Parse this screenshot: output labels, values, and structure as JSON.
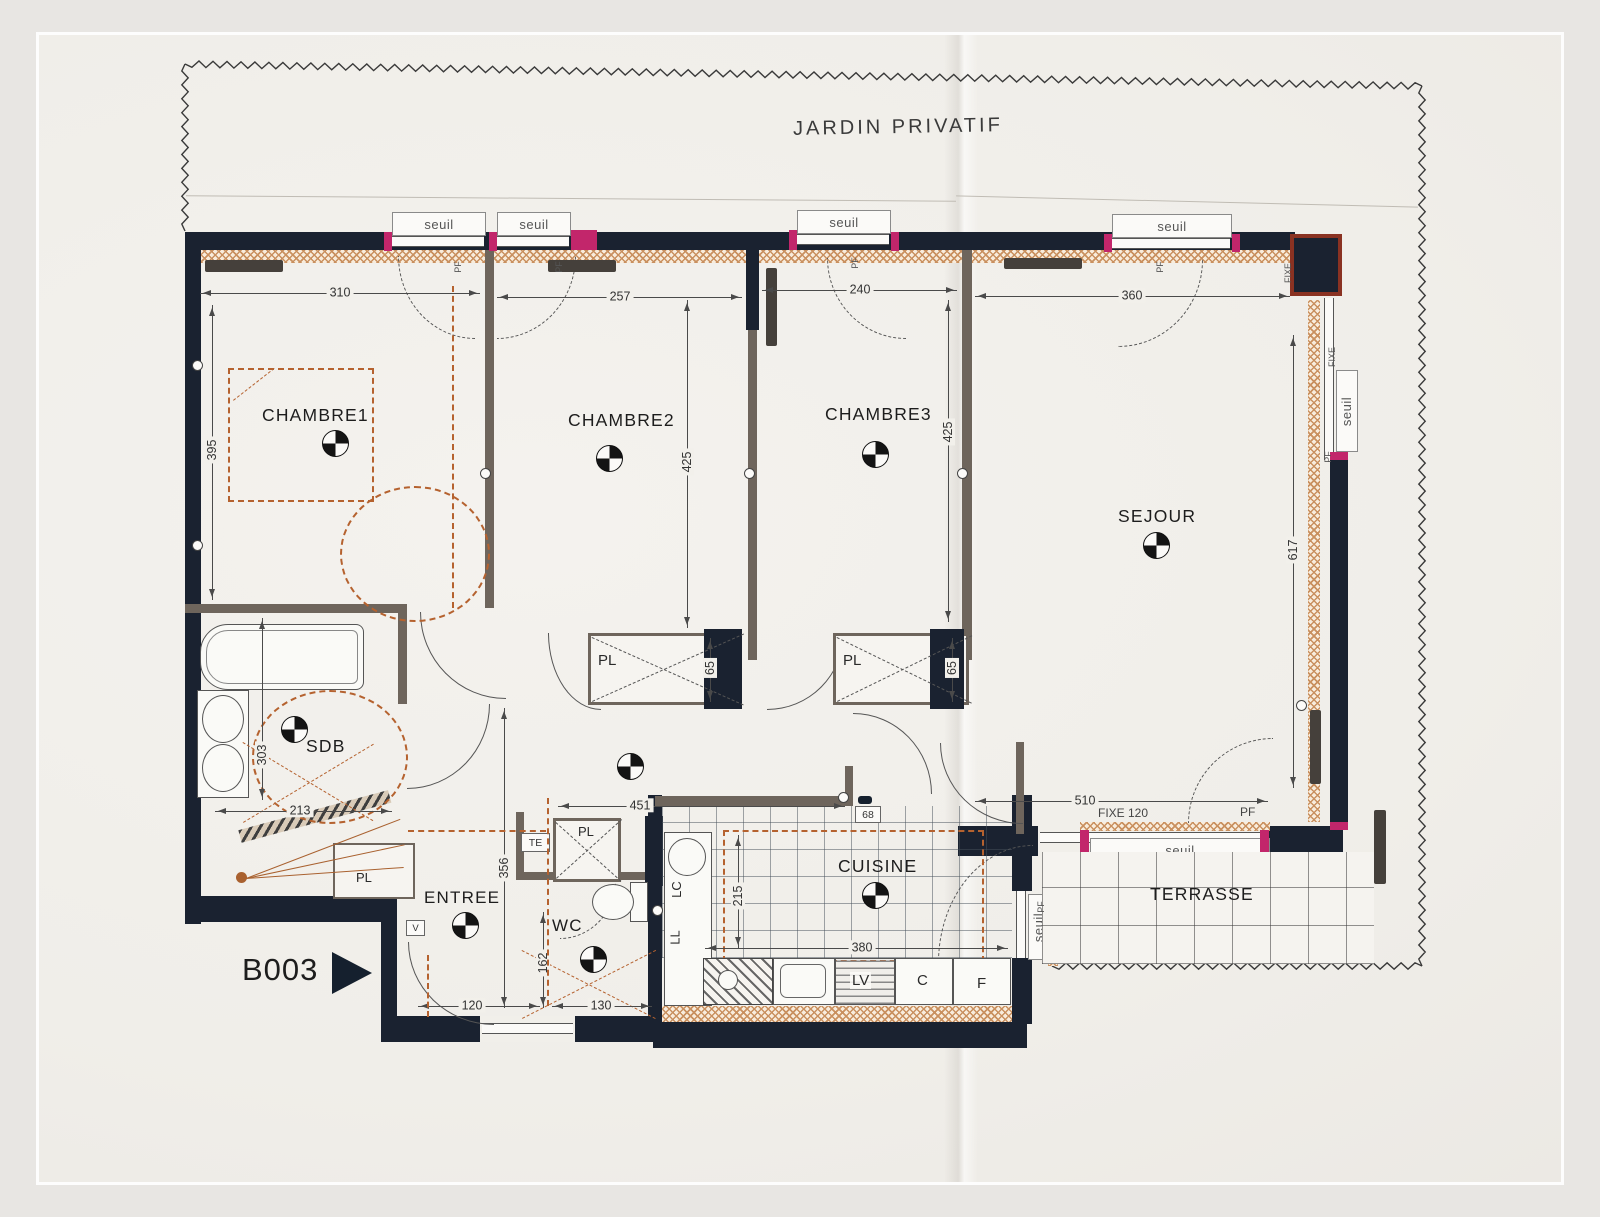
{
  "labels": {
    "jardin": "JARDIN PRIVATIF",
    "unit": "B003"
  },
  "rooms": {
    "ch1": "CHAMBRE1",
    "ch2": "CHAMBRE2",
    "ch3": "CHAMBRE3",
    "sejour": "SEJOUR",
    "sdb": "SDB",
    "entree": "ENTREE",
    "wc": "WC",
    "cuisine": "CUISINE",
    "terrasse": "TERRASSE",
    "pl": "PL"
  },
  "dims": {
    "ch1_w": "310",
    "ch2_w": "257",
    "ch3_w": "240",
    "sejour_w": "360",
    "ch1_h": "395",
    "ch2_h": "425",
    "ch3_h": "425",
    "sejour_h": "617",
    "pl2_d": "65",
    "pl3_d": "65",
    "hall_w": "451",
    "hall_h": "356",
    "sdb_h": "303",
    "sdb_w": "213",
    "sejour_s": "510",
    "fixe120": "FIXE 120",
    "entry_w": "120",
    "wc_w": "130",
    "wc_h": "162",
    "kitchen_h": "215",
    "kitchen_w": "380",
    "pass": "68"
  },
  "openings": {
    "seuil": "seuil",
    "pf": "PF",
    "fixe": "FIXE",
    "te": "TE",
    "v": "V"
  },
  "kitchen": {
    "lv": "LV",
    "c": "C",
    "f": "F",
    "lc": "LC",
    "ll": "LL"
  }
}
